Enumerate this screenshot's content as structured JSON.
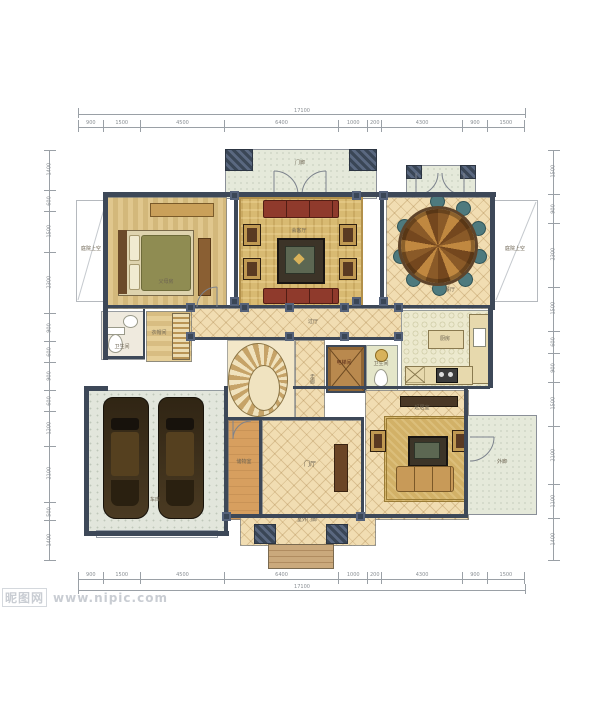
{
  "watermark": {
    "logo": "昵图网",
    "url": "www.nipic.com"
  },
  "dimensions": {
    "top_total": "17100",
    "top_segments": [
      "900",
      "1500",
      "4500",
      "6400",
      "1000",
      "200",
      "4300",
      "900",
      "1500"
    ],
    "bottom_total": "17100",
    "bottom_segments": [
      "900",
      "1500",
      "4500",
      "6400",
      "1000",
      "200",
      "4300",
      "900",
      "1500"
    ],
    "left_segments": [
      "1400",
      "600",
      "1500",
      "2300",
      "900",
      "600",
      "900",
      "600",
      "1200",
      "2100",
      "500",
      "1400"
    ],
    "right_segments": [
      "1500",
      "900",
      "2300",
      "1500",
      "600",
      "900",
      "1500",
      "2100",
      "1100",
      "1400"
    ]
  },
  "rooms": {
    "porch": "门廊",
    "parents_room": "父母房",
    "formal_living": "会客厅",
    "dining": "餐厅",
    "courtyard": "庭院上空",
    "courtyard_right": "庭院上空",
    "bath_1": "卫生间",
    "cloak_room": "衣帽间",
    "hallway": "过厅",
    "corridor": "走廊",
    "elevator": "电梯间",
    "bath_2": "卫生间",
    "kitchen": "厨房",
    "garage": "车库",
    "storage": "储物室",
    "foyer": "门厅",
    "living_room": "起居室",
    "veranda": "外廊",
    "outdoor_porch": "室外门廊"
  }
}
